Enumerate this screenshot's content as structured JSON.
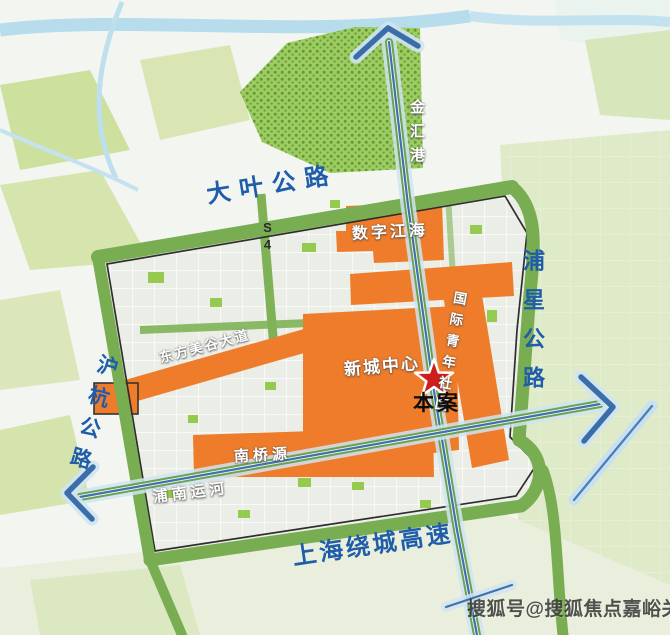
{
  "roads": {
    "daye": "大叶公路",
    "puxing": "浦星公路",
    "huhang": "沪杭公路",
    "raocheng": "上海绕城高速",
    "s4": "S4"
  },
  "waterways": {
    "jinhui": "金汇港",
    "punan": "浦南运河"
  },
  "areas": {
    "shuzi": "数字江海",
    "xincheng": "新城中心",
    "guoji": "国际青年社区",
    "nanqiao": "南桥源",
    "dongfang": "东方美谷大道"
  },
  "marker": {
    "label": "本案"
  },
  "watermark": "搜狐号@搜狐焦点嘉峪关站",
  "colors": {
    "road_green": "#79ad52",
    "district_orange": "#ee7c2b",
    "label_blue": "#1f5dab",
    "star_red": "#d11c1c",
    "water_blue": "#b3dbeb",
    "highway_blue": "#3f72ad",
    "park_dot_green": "#5f9c33"
  }
}
